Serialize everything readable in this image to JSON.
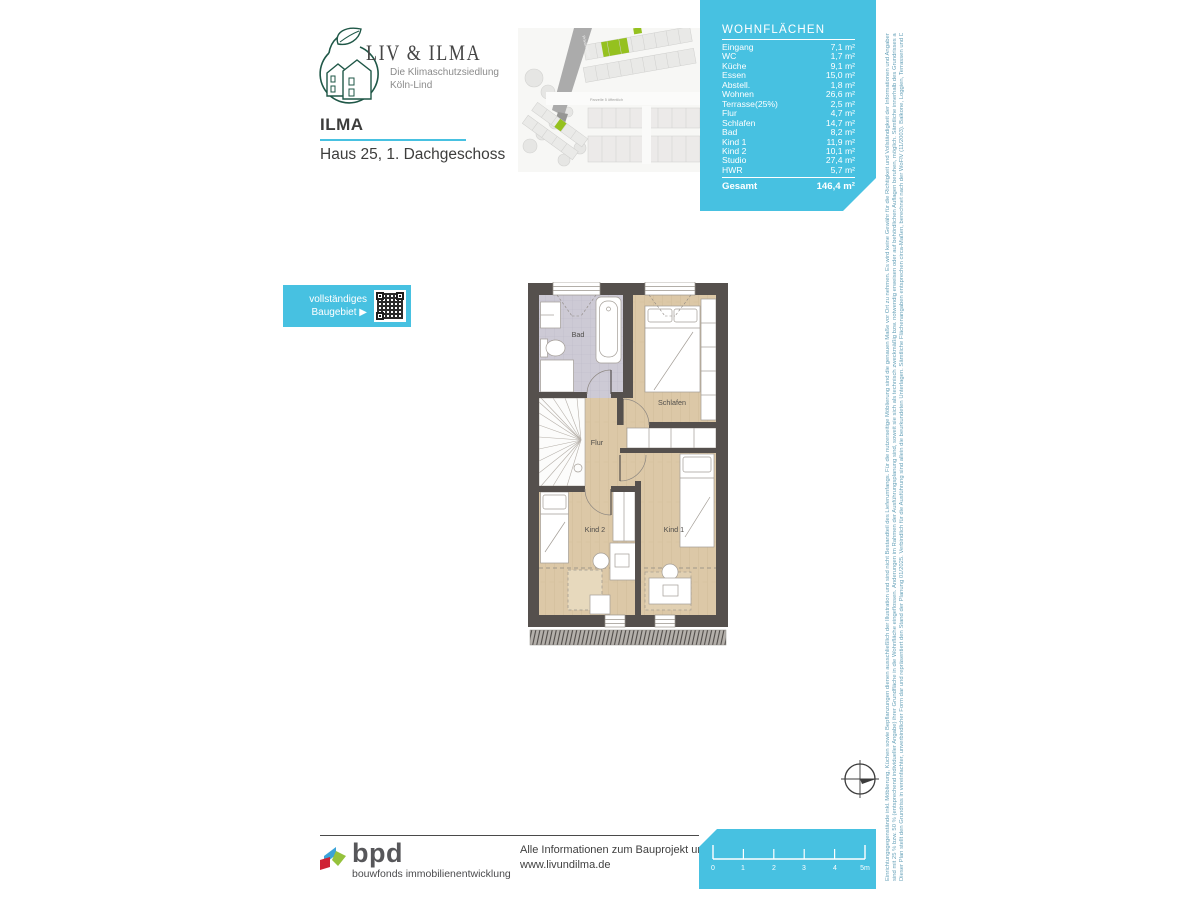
{
  "brand": {
    "title": "LIV & ILMA",
    "subtitle_line1": "Die Klimaschutzsiedlung",
    "subtitle_line2": "Köln-Lind"
  },
  "header": {
    "project": "ILMA",
    "house": "Haus 25, 1. Dachgeschoss"
  },
  "siteplan": {
    "street_label": "Privatstraße",
    "parcel_label": "Parzelle 5 öffentlich"
  },
  "areas": {
    "title": "WOHNFLÄCHEN",
    "rows": [
      {
        "label": "Eingang",
        "value": "7,1 m²"
      },
      {
        "label": "WC",
        "value": "1,7 m²"
      },
      {
        "label": "Küche",
        "value": "9,1 m²"
      },
      {
        "label": "Essen",
        "value": "15,0 m²"
      },
      {
        "label": "Abstell.",
        "value": "1,8 m²"
      },
      {
        "label": "Wohnen",
        "value": "26,6 m²"
      },
      {
        "label": "Terrasse(25%)",
        "value": "2,5 m²"
      },
      {
        "label": "Flur",
        "value": "4,7 m²"
      },
      {
        "label": "Schlafen",
        "value": "14,7 m²"
      },
      {
        "label": "Bad",
        "value": "8,2 m²"
      },
      {
        "label": "Kind 1",
        "value": "11,9 m²"
      },
      {
        "label": "Kind 2",
        "value": "10,1 m²"
      },
      {
        "label": "Studio",
        "value": "27,4 m²"
      },
      {
        "label": "HWR",
        "value": "5,7 m²"
      }
    ],
    "total_label": "Gesamt",
    "total_value": "146,4 m²"
  },
  "baugebiet": {
    "line1": "vollständiges",
    "line2": "Baugebiet ▶"
  },
  "floorplan": {
    "rooms": {
      "bad": "Bad",
      "schlafen": "Schlafen",
      "flur": "Flur",
      "kind2": "Kind 2",
      "kind1": "Kind 1"
    }
  },
  "footer": {
    "logo": "bpd",
    "logo_subtitle": "bouwfonds immobilienentwicklung",
    "info_line1": "Alle Informationen zum Bauprojekt unter:",
    "info_line2": "www.livundilma.de",
    "scale": {
      "ticks": [
        "0",
        "1",
        "2",
        "3",
        "4",
        "5m"
      ]
    }
  },
  "disclaimer": {
    "line1": "Dieser Plan stellt den Grundriss in vereinfachter, unverbindlicher Form dar und repräsentiert den Stand der Planung 01/2025. Verbindlich für die Ausführung sind allein die beurkundeten Unterlagen. Sämtliche Flächenangaben entsprechen circa-Maßen, berechnet nach der WoFlV (11/2003). Balkone, Loggien, Terrassen und Dachterrassen",
    "line2": "sind mit 25 % bzw. 50 % (entsprechend individueller Angabe) ihrer Grundfläche in die Wohnfläche eingeflossen. Änderungen im Rahmen der Ausführungsplanung sind, soweit sie sich als technisch zweckmäßig bzw. notwendig erweisen oder auf behördlichen Auflagen beruhen, möglich. Sämtliche innerhalb des Grundrisses abgebildeten",
    "line3": "Einrichtungsgegenstände inkl. Möblierung, Küchen sowie Bepflanzungen dienen ausschließlich der Illustration und sind nicht Bestandteil des Lieferumfangs. Für die nutzerseitige Möblierung sind die genauen Maße vor Ort zu nehmen. Es wird keine Gewähr für die Richtigkeit und Vollständigkeit der Informationen und Angaben übernommen."
  },
  "colors": {
    "cyan": "#47c1e1",
    "accent_green": "#95c11f",
    "logo_green": "#1f5747",
    "wall": "#55504d",
    "wood_floor": "#dcc8a7",
    "bath_floor": "#cdcad5"
  }
}
